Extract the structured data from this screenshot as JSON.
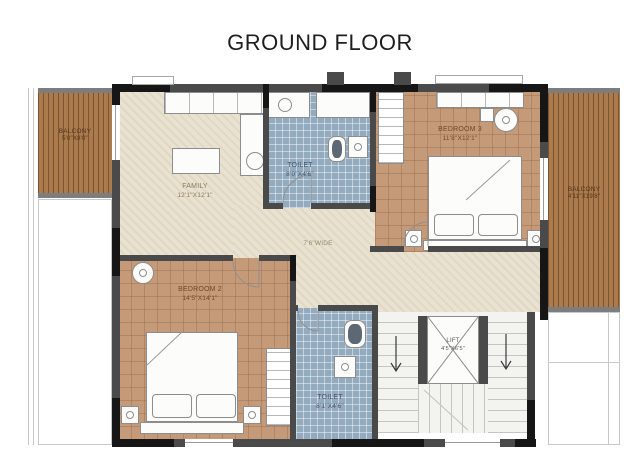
{
  "title": "GROUND FLOOR",
  "rooms": {
    "family": {
      "name": "FAMILY",
      "dims": "12'1\"X12'1\""
    },
    "bedroom3": {
      "name": "BEDROOM 3",
      "dims": "11'8\"X12'1\""
    },
    "bedroom2": {
      "name": "BEDROOM 2",
      "dims": "14'5\"X14'1\""
    },
    "toilet_top": {
      "name": "TOILET",
      "dims": "8'0\"X4'6\""
    },
    "toilet_bottom": {
      "name": "TOILET",
      "dims": "8'1\"X4'6\""
    },
    "lift": {
      "name": "LIFT",
      "dims": "4'5\"X6'5\""
    },
    "balcony_left": {
      "name": "BALCONY",
      "dims": "5'0\"X8'0\""
    },
    "balcony_right": {
      "name": "BALCONY",
      "dims": "4'11\"X19'8\""
    },
    "corridor": {
      "label": "7'6\"WIDE"
    }
  },
  "colors": {
    "wall": "#4a4a4a",
    "wall_dark": "#161616",
    "floor_beige": "#e9e2d0",
    "floor_brown": "#c49a78",
    "floor_tile_blue": "#93abbf",
    "wood_deck": "#ab7a4d",
    "stair_floor": "#f3f3ef"
  }
}
